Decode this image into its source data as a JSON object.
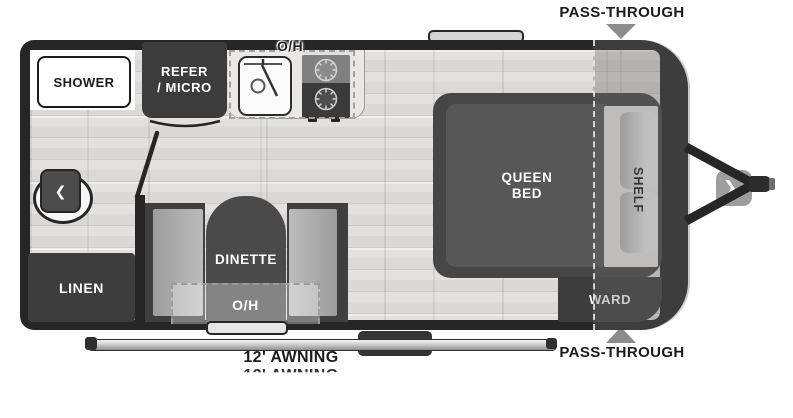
{
  "trailer": {
    "annotations": {
      "pass_through_top": "PASS-THROUGH",
      "pass_through_bottom": "PASS-THROUGH",
      "awning": "12' AWNING"
    },
    "bathroom": {
      "shower": "SHOWER",
      "linen": "LINEN"
    },
    "kitchen": {
      "refer_micro": "REFER\n/ MICRO",
      "overhead": "O/H"
    },
    "dinette": {
      "name": "DINETTE",
      "overhead": "O/H"
    },
    "bedroom": {
      "bed": "QUEEN\nBED",
      "shelf": "SHELF",
      "ward": "WARD"
    },
    "icons": {
      "toilet_chevron": "❮",
      "entry_chevron": "❯"
    },
    "colors": {
      "wall": "#262626",
      "cabinet": "#3d3d3d",
      "floor": "#e0dedc",
      "marker": "#8c8c8c"
    }
  }
}
